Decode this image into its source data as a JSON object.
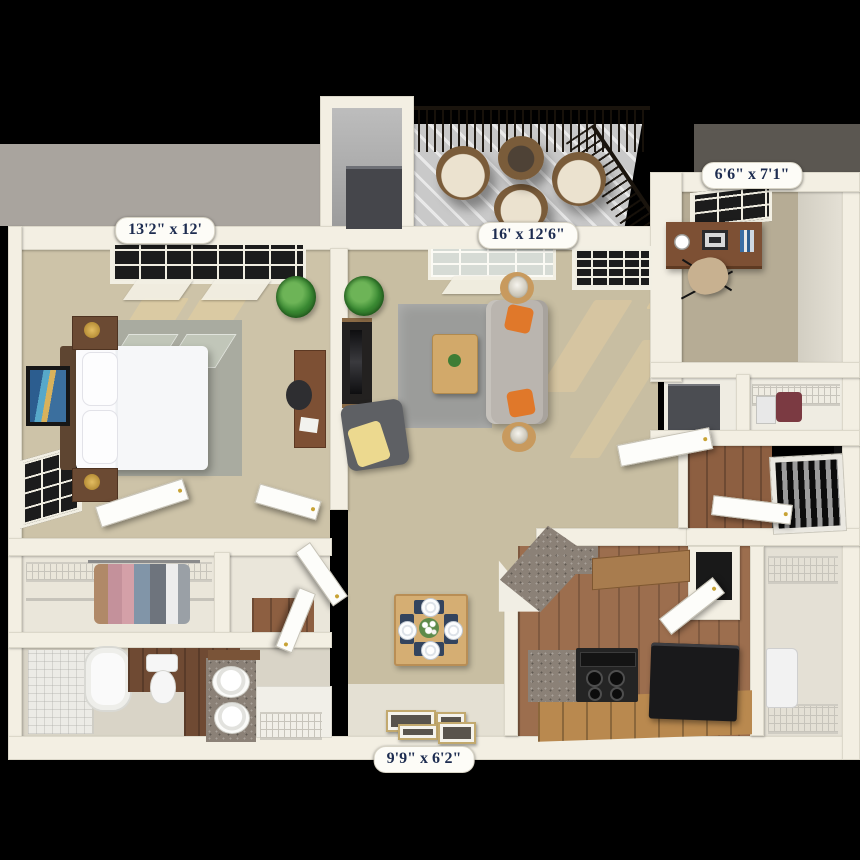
{
  "floor_plan": {
    "labels": {
      "bedroom": "13'2\" x 12'",
      "living_room": "16' x 12'6\"",
      "den": "6'6\" x 7'1\"",
      "kitchen": "9'9\" x 6'2\""
    },
    "colors": {
      "background": "#000000",
      "band_left": "#a9a49e",
      "band_right": "#5b5751",
      "wall": "#f3efe3",
      "carpet": "#c8bea2",
      "bedroom_carpet": "#cdc3a8",
      "wood_floor": "#8d5f41",
      "granite": "#8b8177",
      "rug_gray": "#9b9c9a",
      "sofa": "#bab5af",
      "accent_orange": "#e0782a",
      "dining_navy": "#3c4d63",
      "label_text": "#1d2c50",
      "label_pill": "#fdfcf7"
    }
  }
}
